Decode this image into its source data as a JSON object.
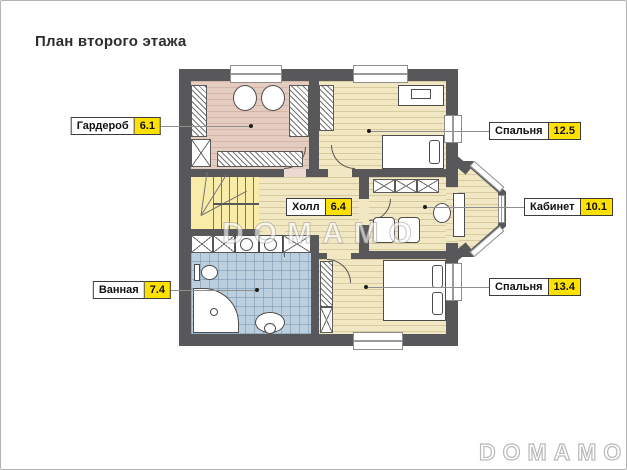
{
  "title": "План второго этажа",
  "plan": {
    "rooms": [
      {
        "name": "Гардероб",
        "area": "6.1"
      },
      {
        "name": "Спальня",
        "area": "12.5"
      },
      {
        "name": "Кабинет",
        "area": "10.1"
      },
      {
        "name": "Холл",
        "area": "6.4"
      },
      {
        "name": "Ванная",
        "area": "7.4"
      },
      {
        "name": "Спальня",
        "area": "13.4"
      }
    ]
  },
  "watermark": "DOMAMO",
  "brand_logo": "DOMAMO",
  "colors": {
    "wall": "#58585a",
    "wood_floor": "#f1e8c3",
    "wardrobe_floor": "#e4ccc1",
    "stairs_floor": "#f8eca8",
    "bathroom_floor": "#bccfdf",
    "area_badge_yellow": "#ffe100",
    "label_border": "#3c3c3c"
  }
}
